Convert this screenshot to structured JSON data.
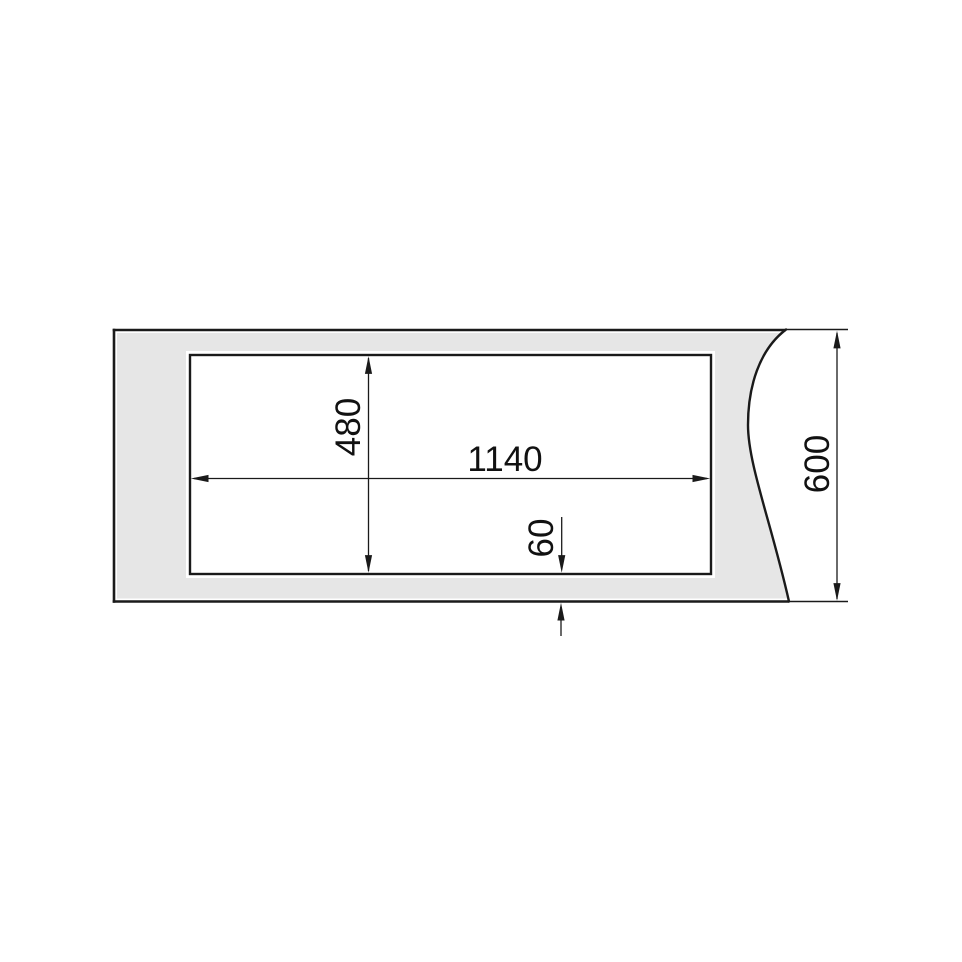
{
  "page": {
    "background_color": "#ffffff",
    "description": "Technical installation drawing of a worktop cutout, top view, with break line on the right edge"
  },
  "drawing": {
    "colors": {
      "surface_fill": "#e6e6e6",
      "cutout_fill": "#ffffff",
      "line_color": "#1a1a1a",
      "text_color": "#111111"
    },
    "dimensions": {
      "cutout_width": {
        "value": "1140",
        "orientation": "horizontal",
        "measures": "cutout opening width"
      },
      "cutout_height": {
        "value": "480",
        "orientation": "vertical",
        "measures": "cutout opening height"
      },
      "bottom_offset": {
        "value": "60",
        "orientation": "vertical",
        "measures": "distance from cutout to front edge"
      },
      "worktop_depth": {
        "value": "600",
        "orientation": "vertical",
        "measures": "overall worktop depth"
      }
    }
  }
}
